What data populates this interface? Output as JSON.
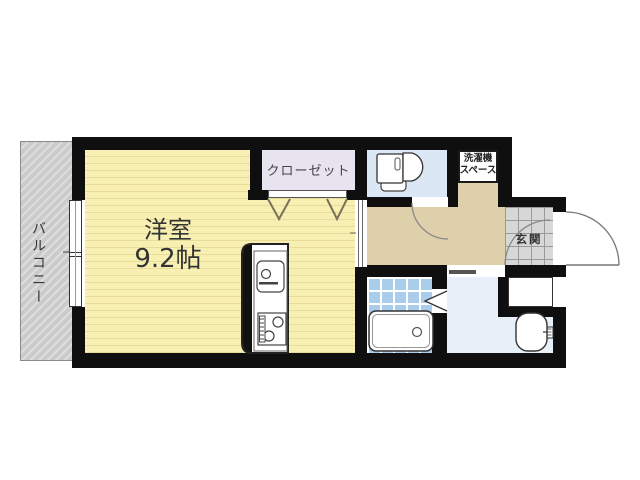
{
  "floorplan": {
    "type": "apartment-floorplan",
    "rooms": {
      "balcony": {
        "label": "バルコニー"
      },
      "western_room": {
        "label": "洋室",
        "size": "9.2帖"
      },
      "closet": {
        "label": "クローゼット"
      },
      "washer_space": {
        "label_line1": "洗濯機",
        "label_line2": "スペース"
      },
      "entrance": {
        "label": "玄関"
      },
      "toilet": {
        "label": ""
      },
      "bathroom": {
        "label": ""
      },
      "washroom": {
        "label": ""
      },
      "hallway": {
        "label": ""
      }
    },
    "fixtures": [
      "toilet",
      "bathtub",
      "washbasin",
      "kitchen-counter",
      "washing-machine-pan"
    ],
    "colors": {
      "wall": "#0f0f0f",
      "tatami_yellow": "#f7f0b2",
      "tatami_stripe": "#e9dc9b",
      "closet_fill": "#e7e3ef",
      "hallway_tan": "#ded0ab",
      "toilet_blue": "#dbe7f4",
      "washroom_blue": "#e7eff8",
      "bath_tile_blue": "#abcdec",
      "entrance_tile_gray": "#d7d7d7",
      "balcony_gray": "#cbcbcb",
      "text": "#333333"
    }
  }
}
